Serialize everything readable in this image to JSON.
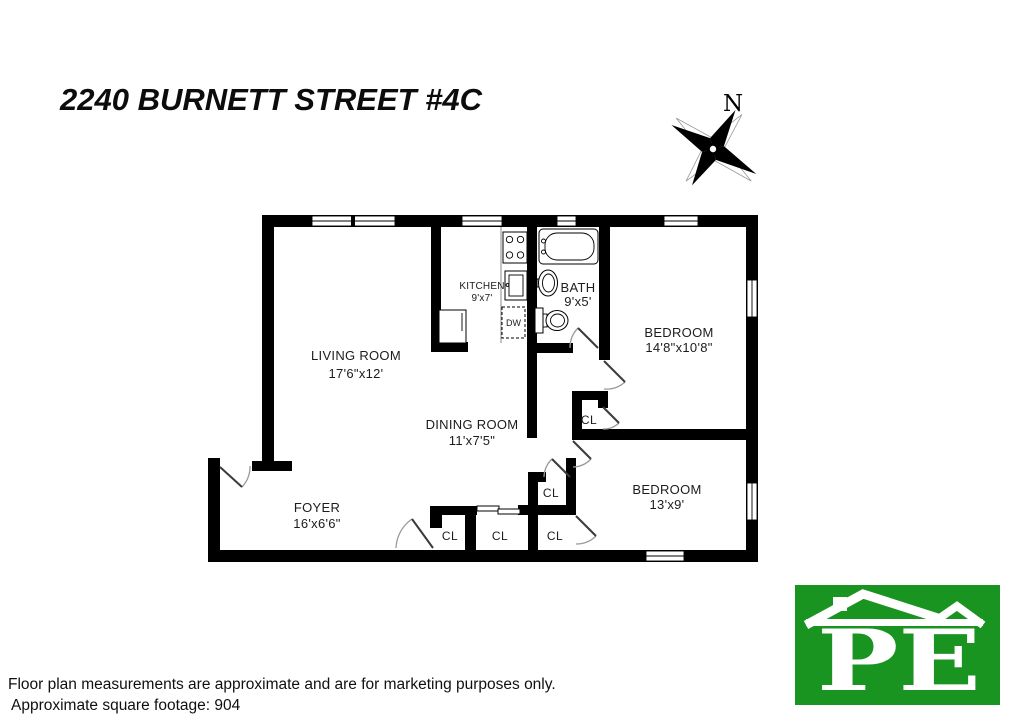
{
  "title": "2240 BURNETT STREET #4C",
  "compass": {
    "north_label": "N"
  },
  "rooms": {
    "living": {
      "name": "LIVING ROOM",
      "dims": "17'6\"x12'"
    },
    "kitchen": {
      "name": "KITCHEN",
      "dims": "9'x7'"
    },
    "bath": {
      "name": "BATH",
      "dims": "9'x5'"
    },
    "bedroom1": {
      "name": "BEDROOM",
      "dims": "14'8\"x10'8\""
    },
    "dining": {
      "name": "DINING ROOM",
      "dims": "11'x7'5\""
    },
    "bedroom2": {
      "name": "BEDROOM",
      "dims": "13'x9'"
    },
    "foyer": {
      "name": "FOYER",
      "dims": "16'x6'6\""
    }
  },
  "closet_label": "CL",
  "fixtures": {
    "dishwasher_label": "DW"
  },
  "logo": {
    "monogram": "PE",
    "green": "#1a9420"
  },
  "footer": {
    "disclaimer": "Floor plan measurements are approximate and are for marketing purposes only.",
    "square_footage": "Approximate square footage: 904"
  }
}
